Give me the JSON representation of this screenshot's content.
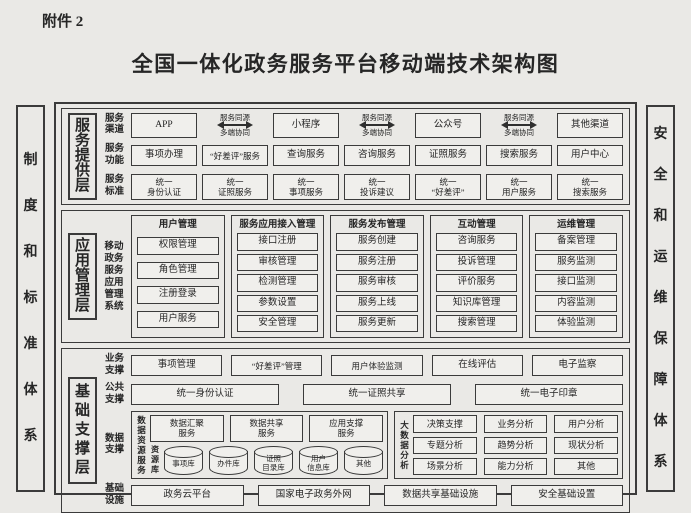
{
  "page": {
    "attachment": "附件 2",
    "title": "全国一体化政务服务平台移动端技术架构图"
  },
  "side": {
    "left": "制度和标准体系",
    "right": "安全和运维保障体系"
  },
  "colors": {
    "paper": "#eae9e6",
    "line": "#3b3b3b",
    "ink": "#262626"
  },
  "service_layer": {
    "label": "服务提供层",
    "channel_row_label": "服务渠道",
    "channels": [
      "APP",
      "小程序",
      "公众号",
      "其他渠道"
    ],
    "sync_top": "服务同源",
    "sync_bottom": "多端协同",
    "function_row_label": "服务功能",
    "functions": [
      "事项办理",
      "“好差评”服务",
      "查询服务",
      "咨询服务",
      "证照服务",
      "搜索服务",
      "用户中心"
    ],
    "standard_row_label": "服务标准",
    "standards": [
      "统一\n身份认证",
      "统一\n证照服务",
      "统一\n事项服务",
      "统一\n投诉建议",
      "统一\n“好差评”",
      "统一\n用户服务",
      "统一\n搜索服务"
    ]
  },
  "app_layer": {
    "label": "应用管理层",
    "system": "移动政务服务应用管理系统",
    "groups": [
      {
        "title": "用户管理",
        "items": [
          "权限管理",
          "角色管理",
          "注册登录",
          "用户服务"
        ]
      },
      {
        "title": "服务应用接入管理",
        "items": [
          "接口注册",
          "审核管理",
          "检测管理",
          "参数设置",
          "安全管理"
        ]
      },
      {
        "title": "服务发布管理",
        "items": [
          "服务创建",
          "服务注册",
          "服务审核",
          "服务上线",
          "服务更新"
        ]
      },
      {
        "title": "互动管理",
        "items": [
          "咨询服务",
          "投诉管理",
          "评价服务",
          "知识库管理",
          "搜索管理"
        ]
      },
      {
        "title": "运维管理",
        "items": [
          "备案管理",
          "服务监测",
          "接口监测",
          "内容监测",
          "体验监测"
        ]
      }
    ]
  },
  "foundation_layer": {
    "label": "基础支撑层",
    "business_row_label": "业务支撑",
    "business": [
      "事项管理",
      "“好差评”管理",
      "用户体验监测",
      "在线评估",
      "电子监察"
    ],
    "public_row_label": "公共支撑",
    "public": [
      "统一身份认证",
      "统一证照共享",
      "统一电子印章"
    ],
    "data_row_label": "数据支撑",
    "data_resource": {
      "label": "数据资源服务",
      "services": [
        "数据汇聚\n服务",
        "数据共享\n服务",
        "应用支撑\n服务"
      ],
      "repo_label": "资源库",
      "repos": [
        "事项库",
        "办件库",
        "证照\n目录库",
        "用户\n信息库",
        "其他"
      ]
    },
    "big_data": {
      "label": "大数据分析",
      "items": [
        "决策支撑",
        "业务分析",
        "用户分析",
        "专题分析",
        "趋势分析",
        "现状分析",
        "场景分析",
        "能力分析",
        "其他"
      ]
    },
    "infra_row_label": "基础设施",
    "infra": [
      "政务云平台",
      "国家电子政务外网",
      "数据共享基础设施",
      "安全基础设置"
    ]
  }
}
